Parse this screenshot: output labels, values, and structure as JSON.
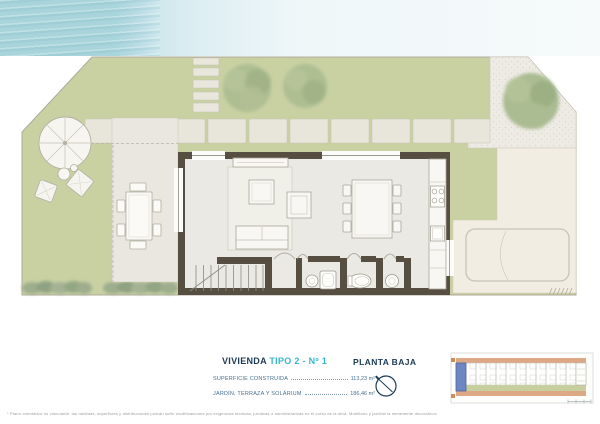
{
  "document": {
    "type": "floor-plan",
    "unit_title": {
      "prefix": "VIVIENDA ",
      "highlight": "TIPO 2 - Nº 1"
    },
    "plan_name": "PLANTA BAJA",
    "specs": [
      {
        "label": "SUPERFICIE  CONSTRUIDA",
        "value": "113,23  m²"
      },
      {
        "label": "JARDÍN,  TERRAZA  Y  SOLÁRIUM",
        "value": "186,46  m²"
      }
    ],
    "disclaimer": "* Plano orientativo no vinculante: las medidas, superficies y distribuciones podrán sufrir modificaciones por exigencias técnicas, jurídicas o administrativas en el curso de la obra. Mobiliario y jardinería meramente decorativos no incluidos."
  },
  "colors": {
    "lawn": "#c9d1a3",
    "tree": "#a9bb8e",
    "terrace": "#e9e7df",
    "interior_floor": "#eae9e3",
    "wall_dark": "#564e41",
    "driveway": "#f1ede2",
    "gravel": "#edebe4",
    "water_blue": "#aed6de",
    "navy": "#1b3a55",
    "accent_cyan": "#35b6ce",
    "keyplan_highlight": "#6e87c2",
    "keyplan_frame": "#dca886",
    "keyplan_garden": "#c6cf9d"
  },
  "icons": {
    "north_indicator": "compass-circle",
    "entrance_marker": "triangle-down"
  }
}
